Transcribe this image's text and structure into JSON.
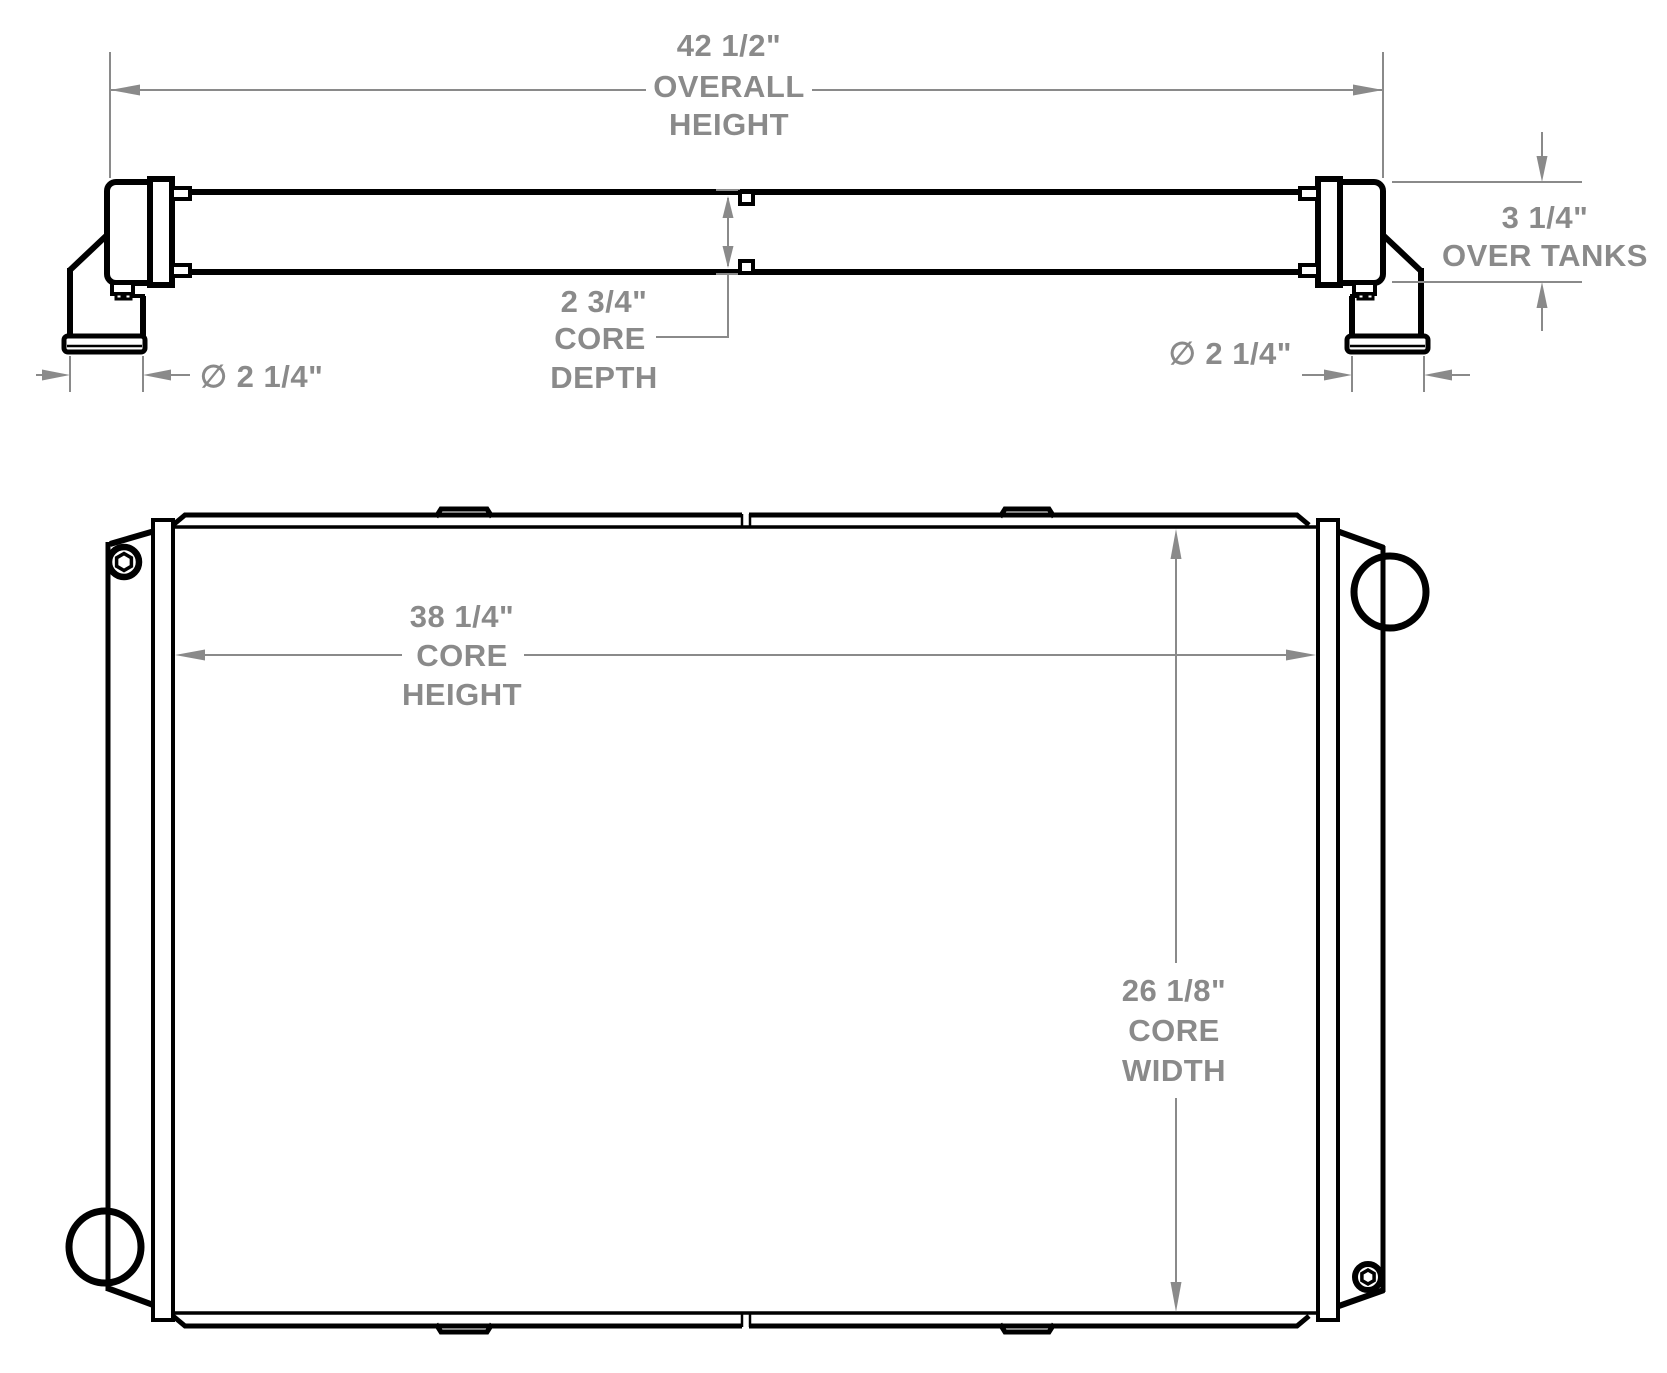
{
  "colors": {
    "line_black": "#000000",
    "dimension_gray": "#8a8a8a",
    "background": "#ffffff"
  },
  "top_view": {
    "overall_height": {
      "value": "42 1/2\"",
      "line1": "OVERALL",
      "line2": "HEIGHT"
    },
    "core_depth": {
      "value": "2 3/4\"",
      "line1": "CORE",
      "line2": "DEPTH"
    },
    "pipe_diameter_left": {
      "value": "∅ 2 1/4\""
    },
    "pipe_diameter_right": {
      "value": "∅ 2 1/4\""
    },
    "over_tanks": {
      "value": "3 1/4\"",
      "line1": "OVER TANKS"
    }
  },
  "front_view": {
    "core_height": {
      "value": "38 1/4\"",
      "line1": "CORE",
      "line2": "HEIGHT"
    },
    "core_width": {
      "value": "26 1/8\"",
      "line1": "CORE",
      "line2": "WIDTH"
    }
  }
}
